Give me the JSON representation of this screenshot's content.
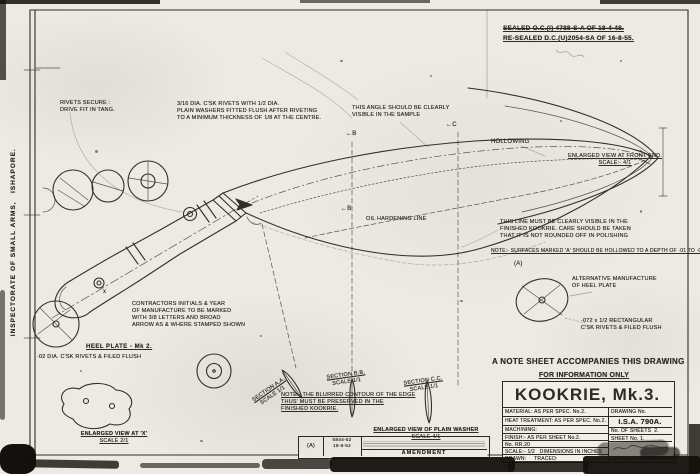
{
  "colors": {
    "paper": "#edeae3",
    "ink": "#332e27"
  },
  "sheet": {
    "agency_vertical": "INSPECTORATE OF SMALL ARMS,   ISHAPORE.",
    "seal": {
      "line1": "SEALED O.C.(I) 4788-S-A OF 18-4-48.",
      "line2": "RE-SEALED D.C.(U)2054-SA OF 16-8-55."
    }
  },
  "notes": {
    "rivets": [
      "RIVETS SECURE :",
      "DRIVE FIT IN TANG."
    ],
    "washers": [
      "3/16 DIA. C'SK RIVETS WITH 1/2 DIA.",
      "PLAIN WASHERS FITTED FLUSH AFTER RIVETING",
      "TO A MINIMUM THICKNESS OF 1/8 AT THE CENTRE."
    ],
    "angle": [
      "THIS ANGLE SHOULD BE CLEARLY",
      "VISIBLE IN THE SAMPLE"
    ],
    "edge_line": [
      "THIS LINE MUST BE CLEARLY VISIBLE IN THE",
      "FINISHED KOOKRIE. CARE SHOULD BE TAKEN",
      "THAT IT IS NOT ROUNDED OFF IN POLISHING"
    ],
    "hollowed": "NOTE:- SURFACES MARKED 'A' SHOULD BE HOLLOWED TO A DEPTH OF ·01 TO ·02",
    "contractors": [
      "CONTRACTORS INITIALS & YEAR",
      "OF MANUFACTURE TO BE MARKED",
      "WITH 3/8 LETTERS AND BROAD",
      "ARROW AS & WHERE STAMPED SHOWN"
    ],
    "blurred_edge": [
      "NOTE:- THE BLURRED CONTOUR OF THE EDGE",
      "THUS' MUST BE PRESERVED IN THE",
      "FINISHED KOOKRIE."
    ],
    "alt_heel": [
      "ALTERNATIVE MANUFACTURE",
      "OF HEEL PLATE"
    ],
    "rect_rivets": [
      "·072 x 1/2 RECTANGULAR",
      "C'SK RIVETS & FILED FLUSH"
    ]
  },
  "labels": {
    "hollowing": "HOLLOWING",
    "oil_line": "OIL HARDENING LINE",
    "heel_plate": "HEEL PLATE - Mk 2.",
    "heel_rivets": "·02 DIA. C'SK RIVETS & FILED FLUSH"
  },
  "markers": {
    "b_top": "←B",
    "c_top": "←C",
    "b_mid": "←B",
    "a_surface": "(A)",
    "x": "x"
  },
  "views": {
    "front_end": [
      "ENLARGED VIEW AT FRONT END.",
      "SCALE:- 4/1"
    ],
    "at_x": [
      "ENLARGED VIEW AT 'X'",
      "SCALE 2/1"
    ],
    "washer": [
      "ENLARGED VIEW OF PLAIN WASHER",
      "SCALE 4/1"
    ],
    "section_a": [
      "SECTION A.A.",
      "SCALE 1/1"
    ],
    "section_b": [
      "SECTION B.B.",
      "SCALE 1/1"
    ],
    "section_c": [
      "SECTION C.C.",
      "SCALE 1/1"
    ]
  },
  "title_block": {
    "note_sheet": "A NOTE SHEET ACCOMPANIES THIS DRAWING",
    "info_only": "FOR INFORMATION ONLY",
    "title": "KOOKRIE, Mk.3.",
    "rows": [
      {
        "left": "MATERIAL: AS PER SPEC. No.2.",
        "right": "DRAWING No."
      },
      {
        "left": "HEAT TREATMENT: AS PER SPEC. No.2.",
        "right": "I.S.A. 790A."
      },
      {
        "left": "MACHINING:",
        "right": "No. OF SHEETS  2."
      },
      {
        "left": "FINISH:- AS PER SHEET No.2.",
        "right": "SHEET No. 1."
      },
      {
        "left": "No. RR.20",
        "right": ""
      },
      {
        "left": "SCALE:- 1/2   DIMENSIONS IN INCHES",
        "right": ""
      },
      {
        "left": "DRAWN:     TRACED:",
        "right": "CHECKED: 16-1-48"
      }
    ]
  },
  "amendment": {
    "index": "(A)",
    "ref": "5844-52",
    "date": "18-8-52",
    "caption": "AMENDMENT"
  }
}
